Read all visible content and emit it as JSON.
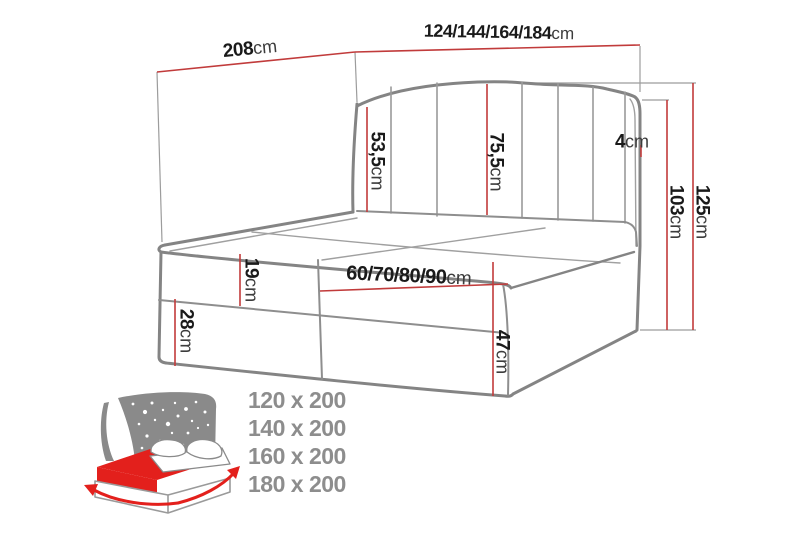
{
  "diagram": {
    "type": "bed-dimension-diagram",
    "labels": {
      "depth": {
        "value": "208",
        "unit": "cm"
      },
      "width": {
        "value": "124/144/164/184",
        "unit": "cm"
      },
      "headboard_left_height": {
        "value": "53,5",
        "unit": "cm"
      },
      "headboard_center_height": {
        "value": "75,5",
        "unit": "cm"
      },
      "headboard_edge": {
        "value": "4",
        "unit": "cm"
      },
      "back_height": {
        "value": "103",
        "unit": "cm"
      },
      "total_height": {
        "value": "125",
        "unit": "cm"
      },
      "mattress_thickness": {
        "value": "19",
        "unit": "cm"
      },
      "half_width": {
        "value": "60/70/80/90",
        "unit": "cm"
      },
      "base_lower_height": {
        "value": "28",
        "unit": "cm"
      },
      "base_total_height": {
        "value": "47",
        "unit": "cm"
      }
    },
    "sizes": [
      "120 x 200",
      "140 x 200",
      "160 x 200",
      "180 x 200"
    ],
    "colors": {
      "dimension_line": "#c13b3b",
      "drawing_line": "#848484",
      "icon_red": "#e3201c",
      "icon_gray": "#8a8a8a",
      "sizes_text": "#8d8d8d",
      "label_text": "#1a1a1a"
    }
  }
}
